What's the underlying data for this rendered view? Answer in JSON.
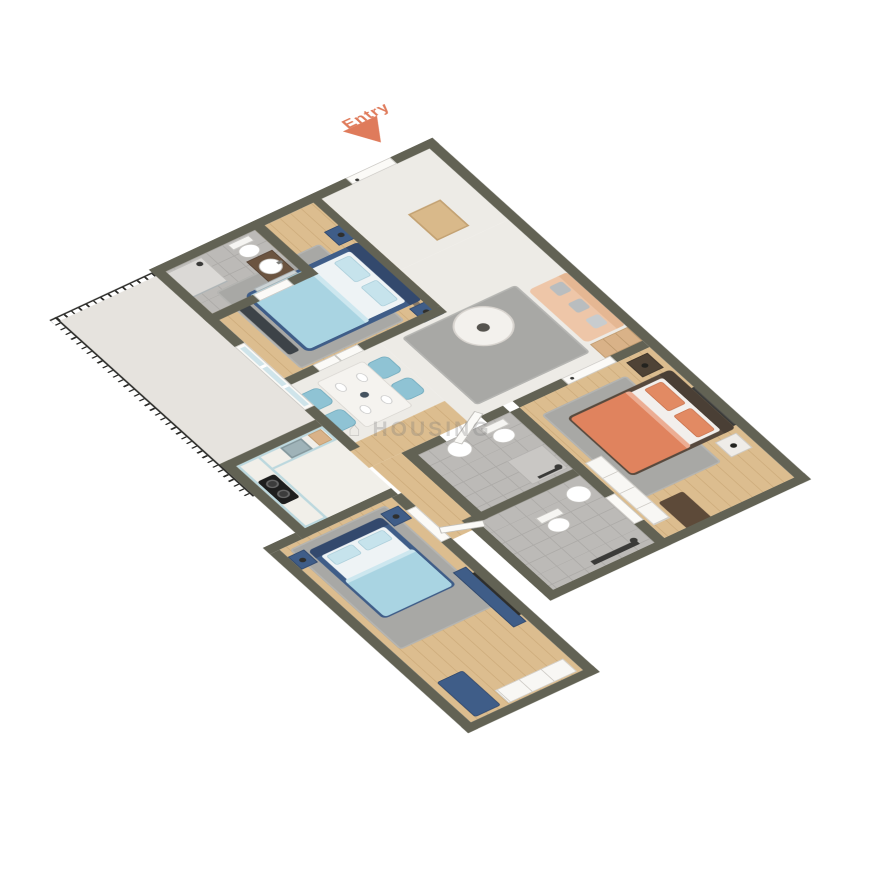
{
  "scene": {
    "entry_label": "Entry",
    "watermark_text": "⌂ HOUSING",
    "view": "3d-isometric-floor-plan"
  },
  "palette": {
    "wall": "#626254",
    "marble": "#edebe6",
    "marble-light": "#f1efe9",
    "wood": "#dcbd8f",
    "wood-line": "#cfae7e",
    "tile": "#bcbab7",
    "grout": "#adaba8",
    "concrete": "#e6e3de",
    "rug": "#a8a8a5",
    "navy": "#3f5d88",
    "navy-deep": "#33496d",
    "blue-light": "#a9d4e2",
    "blue-pale": "#c6e3ec",
    "chair-blue": "#8fc3d4",
    "cabinet-blue": "#bcd8de",
    "peach": "#eec6a8",
    "peach-dark": "#e5b793",
    "coral": "#df7b5b",
    "orange-bed": "#e0835e",
    "orange-pillow": "#e28a63",
    "brown-dark": "#4a3f35",
    "wood-brown": "#6b5440",
    "door-white": "#fbfaf7",
    "rail": "#2b2b28",
    "tv-dark": "#2e2e2c",
    "pillow-gray": "#b9bdbf",
    "decor-blue": "#8ec4d6",
    "mat": "#d9b98a",
    "watermark": "rgba(120,120,120,0.28)"
  },
  "rooms": [
    {
      "name": "entry-foyer",
      "floor": "marble",
      "items": [
        "entry-door",
        "doormat"
      ]
    },
    {
      "name": "living-room",
      "floor": "marble",
      "items": [
        "sofa",
        "coffee-table",
        "area-rug",
        "tall-cabinet",
        "wall-tv",
        "floating-shelf"
      ]
    },
    {
      "name": "dining-area",
      "floor": "marble",
      "items": [
        "dining-table",
        "chair x4",
        "place-setting x4"
      ]
    },
    {
      "name": "bedroom-1",
      "floor": "wood",
      "items": [
        "double-bed-blue",
        "nightstand x2",
        "wall-decor-oval",
        "wall-decor-ring",
        "foot-bench",
        "area-rug"
      ]
    },
    {
      "name": "bathroom-1",
      "floor": "tile",
      "items": [
        "vanity-sink",
        "mirror",
        "toilet",
        "shower"
      ]
    },
    {
      "name": "balcony",
      "floor": "concrete",
      "items": [
        "railing-metal",
        "sliding-glass-door"
      ]
    },
    {
      "name": "kitchen",
      "floor": "marble",
      "items": [
        "l-counter-blue",
        "gas-hob",
        "sink",
        "cutting-board"
      ]
    },
    {
      "name": "common-bathroom",
      "floor": "tile",
      "items": [
        "wall-hung-toilet",
        "washbasin",
        "shower-corner"
      ]
    },
    {
      "name": "bedroom-3",
      "floor": "wood",
      "items": [
        "double-bed-orange",
        "nightstand x2",
        "wall-art",
        "wardrobe-sliding",
        "bench-brown",
        "wall-tv",
        "area-rug"
      ]
    },
    {
      "name": "ensuite-bathroom",
      "floor": "tile",
      "items": [
        "toilet",
        "washbasin",
        "shower-panel"
      ]
    },
    {
      "name": "bedroom-2",
      "floor": "wood",
      "items": [
        "double-bed-blue",
        "nightstand x2",
        "tv-console-navy",
        "bench-navy",
        "wardrobe",
        "area-rug"
      ]
    }
  ]
}
